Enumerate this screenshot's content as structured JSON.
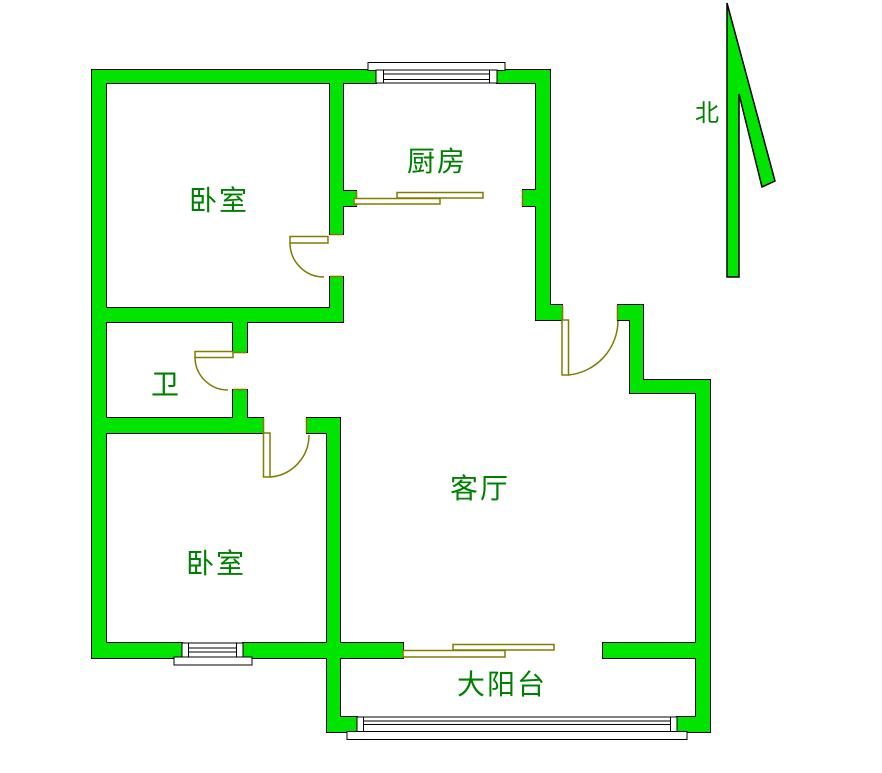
{
  "colors": {
    "wall": "#00E400",
    "label": "#008000",
    "door": "#827B00",
    "outline": "#000000",
    "background": "#FFFFFF"
  },
  "rooms": {
    "bedroom_north": "卧室",
    "kitchen": "厨房",
    "bathroom": "卫",
    "living_room": "客厅",
    "bedroom_south": "卧室",
    "balcony": "大阳台"
  },
  "compass": {
    "north": "北"
  }
}
